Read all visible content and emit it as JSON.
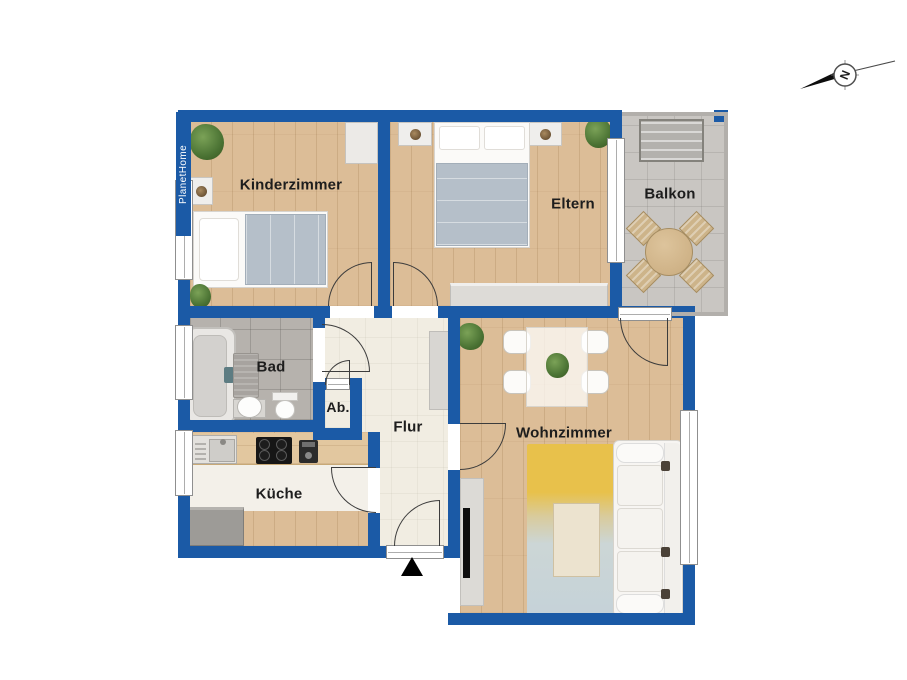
{
  "brand": {
    "label": "PlanetHome"
  },
  "compass": {
    "letter": "N"
  },
  "rooms": {
    "kinderzimmer": {
      "label": "Kinderzimmer"
    },
    "eltern": {
      "label": "Eltern"
    },
    "balkon": {
      "label": "Balkon"
    },
    "bad": {
      "label": "Bad"
    },
    "ab": {
      "label": "Ab."
    },
    "flur": {
      "label": "Flur"
    },
    "kueche": {
      "label": "Küche"
    },
    "wohnzimmer": {
      "label": "Wohnzimmer"
    }
  },
  "palette": {
    "wall_blue": "#1b5aa6",
    "wood_floor": "#dcbd97",
    "hall_floor": "#f1ede2",
    "bath_tile": "#b6b2ad",
    "balcony_tile": "#c9c6c2",
    "blanket_gray": "#b5bfc9",
    "rug_yellow": "#e8c14b",
    "rug_blue": "#c5d2d8",
    "entrance_marker": "#000000"
  }
}
